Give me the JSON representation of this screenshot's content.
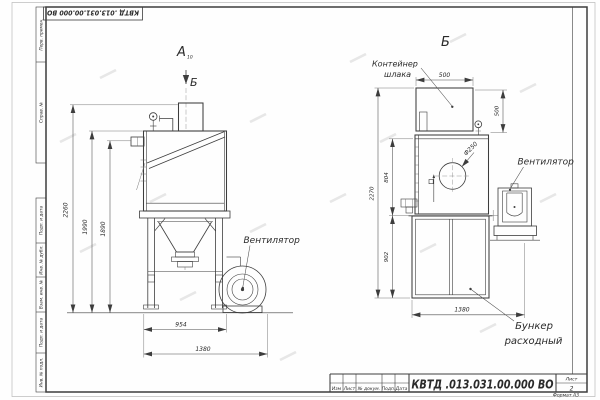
{
  "sheet": {
    "stamp": "КВТД .013.031.00.000  ВО",
    "side_labels": [
      "Перв. примен.",
      "Справ. №",
      "Подп. и дата",
      "Инв. № дубл.",
      "Взам. инв. №",
      "Подп. и дата",
      "Инв. № подл."
    ],
    "title_block": {
      "cols": [
        "Изм",
        "Лист",
        "№ докум.",
        "Подп.",
        "Дата"
      ],
      "doc_number": "КВТД .013.031.00.000  ВО",
      "sheet_label": "Лист",
      "sheet_number": "2",
      "format": "Формат А3"
    }
  },
  "view_a": {
    "label": "А",
    "label_sub": "10",
    "section_mark": "Б",
    "fan_label": "Вентилятор",
    "dim_height_total": "2260",
    "dim_height_body": "1990",
    "dim_height_bracket": "1890",
    "dim_width_body": "954",
    "dim_width_total": "1380"
  },
  "view_b": {
    "label": "Б",
    "container_label": [
      "Контейнер",
      "шлака"
    ],
    "fan_label": "Вентилятор",
    "hopper_label": [
      "Бункер",
      "расходный"
    ],
    "dim_container_width": "500",
    "dim_container_height": "500",
    "dim_door_height": "804",
    "dim_height_total": "2270",
    "dim_hopper_height": "902",
    "dim_width_total": "1380",
    "dim_opening": "Ф250"
  }
}
